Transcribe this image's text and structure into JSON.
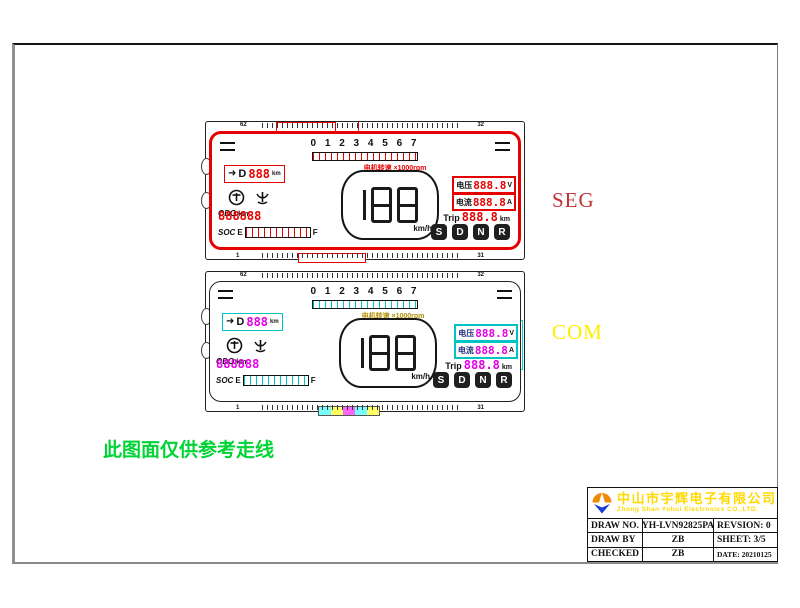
{
  "annotations": {
    "seg_label": "SEG",
    "com_label": "COM",
    "note": "此图面仅供参考走线",
    "seg_color": "#c23030",
    "com_color": "#ffee00",
    "note_color": "#00d435"
  },
  "lcd": {
    "pin_top_left": "62",
    "pin_top_right": "32",
    "pin_bottom_left": "1",
    "pin_bottom_right": "31",
    "digits_row": "0 1 2 3 4 5 6 7",
    "motor_speed_label": "电机转速 ×1000rpm",
    "gear_arrow": "➜",
    "gear_letter": "D",
    "gear_value": "888",
    "gear_unit": "km",
    "speed_value": "188",
    "speed_unit": "km/h",
    "voltage_label": "电压",
    "voltage_value": "888.8",
    "voltage_unit": "V",
    "current_label": "电流",
    "current_value": "888.8",
    "current_unit": "A",
    "trip_label": "Trip",
    "trip_value": "888.8",
    "trip_unit": "km",
    "odo_label": "ODO",
    "odo_value": "888888",
    "odo_unit": "km",
    "soc_label": "SOC",
    "soc_empty": "E",
    "soc_full": "F",
    "gears": [
      "S",
      "D",
      "N",
      "R"
    ],
    "seg_trace_color": "#e60000",
    "com_trace_colors": [
      "#00c4c4",
      "#e0e000",
      "#e400e4",
      "#2a2ac0"
    ]
  },
  "titleblock": {
    "company_cn": "中山市宇辉电子有限公司",
    "company_en": "Zhong Shan Yuhui Electronics CO.,LTD.",
    "company_color": "#ffd900",
    "rows": [
      {
        "label": "DRAW NO.",
        "value": "YH-LVN92825PA",
        "right": "REVSION:  0"
      },
      {
        "label": "DRAW BY",
        "value": "ZB",
        "right": "SHEET: 3/5"
      },
      {
        "label": "CHECKED BY",
        "value": "ZB",
        "right": "DATE: 20210125"
      }
    ]
  }
}
